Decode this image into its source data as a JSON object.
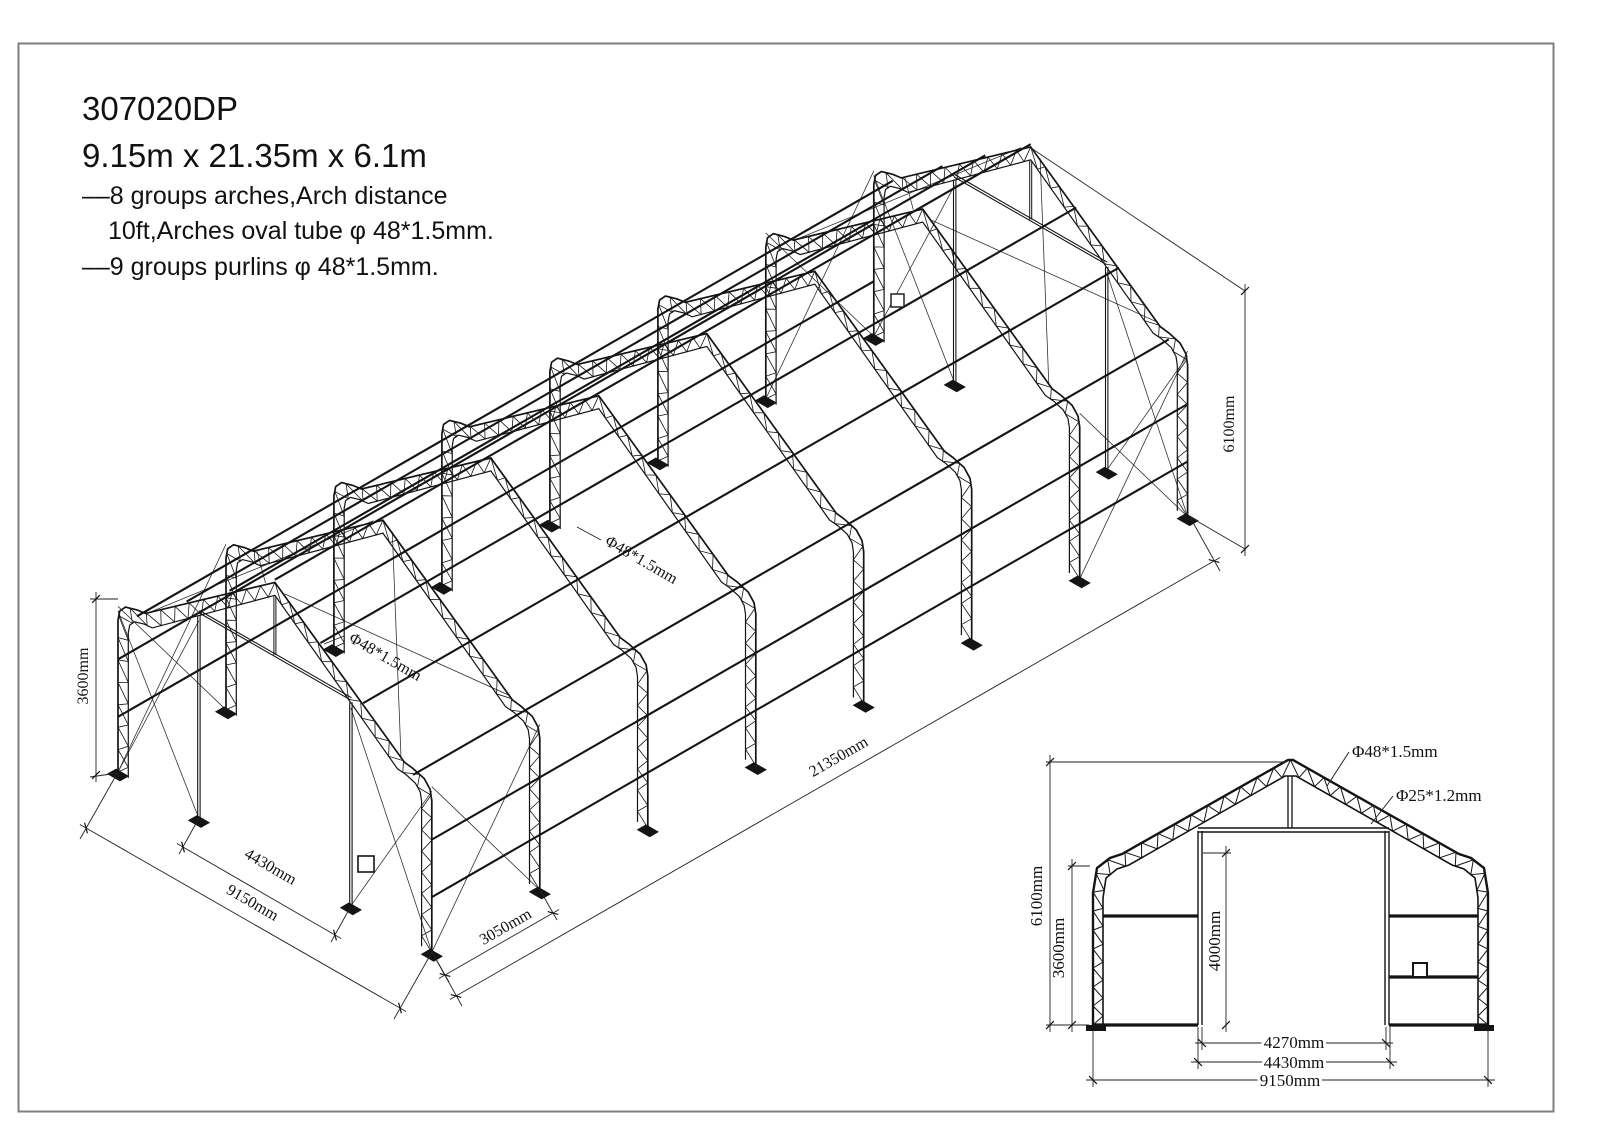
{
  "title_block": {
    "model": "307020DP",
    "size": "9.15m x 21.35m x 6.1m",
    "spec_arches": "––8 groups arches,Arch distance",
    "spec_arch_tube": "10ft,Arches oval tube  φ 48*1.5mm.",
    "spec_purlins": "––9 groups purlins  φ 48*1.5mm."
  },
  "isometric_view": {
    "dim_eave_height": "3600mm",
    "dim_door_width": "4430mm",
    "dim_total_width": "9150mm",
    "dim_bay_spacing": "3050mm",
    "dim_total_length": "21350mm",
    "dim_total_height": "6100mm",
    "label_arch_tube": "Φ48*1.5mm",
    "label_purlin_tube": "Φ48*1.5mm"
  },
  "front_view": {
    "dim_total_height": "6100mm",
    "dim_eave_height": "3600mm",
    "dim_door_height": "4000mm",
    "dim_door_clear_width": "4270mm",
    "dim_door_frame_width": "4430mm",
    "dim_total_width": "9150mm",
    "label_main_tube": "Φ48*1.5mm",
    "label_web_tube": "Φ25*1.2mm"
  },
  "colors": {
    "line": "#141414",
    "border": "#7f7f7f",
    "background": "#ffffff"
  }
}
